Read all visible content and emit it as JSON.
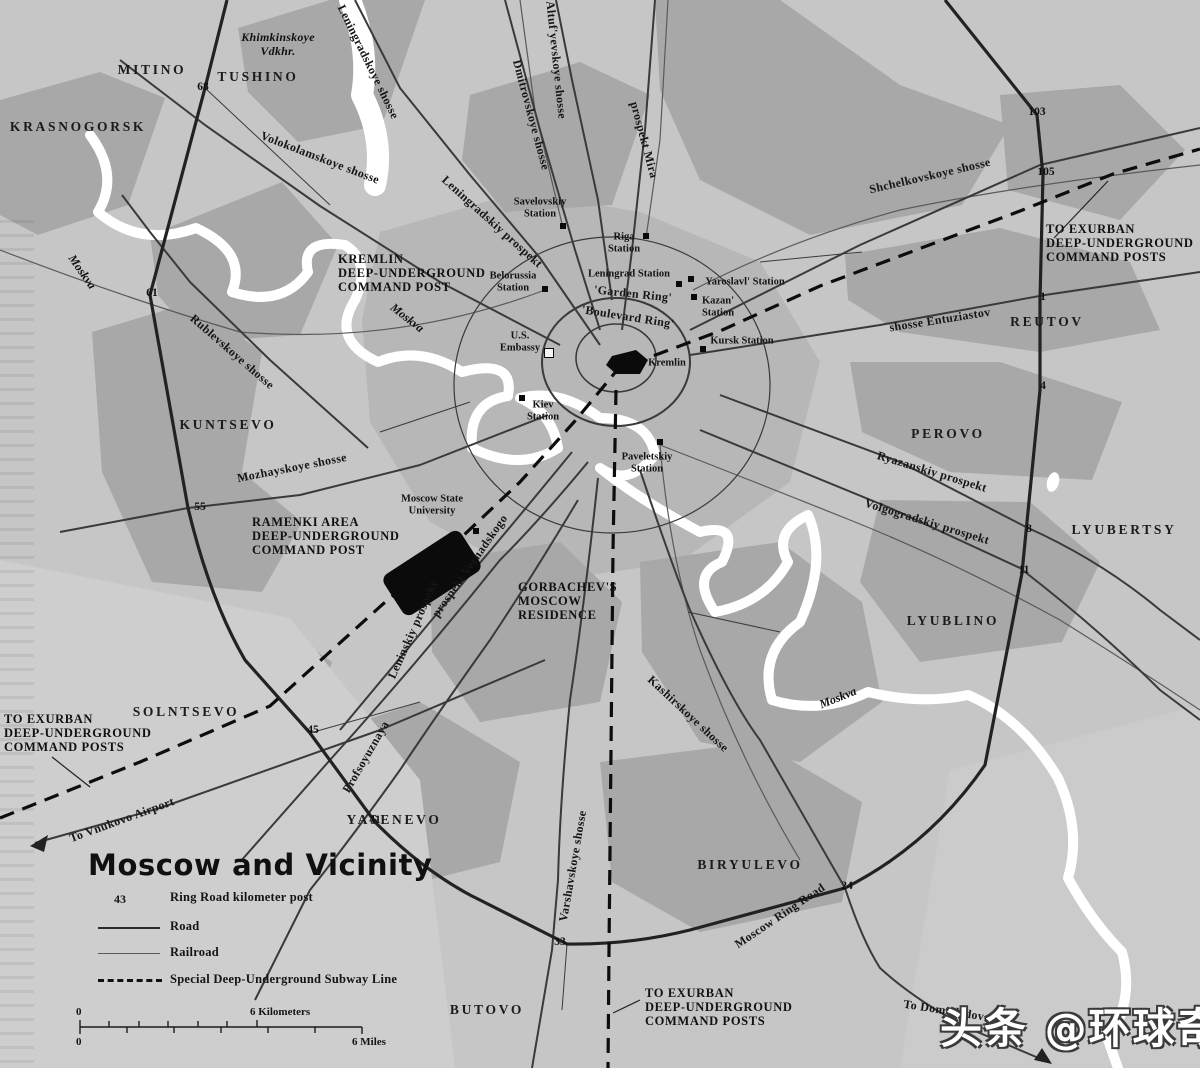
{
  "title": "Moscow and Vicinity",
  "watermark": "头条 @环球奇潭",
  "colors": {
    "background": "#c6c6c6",
    "urban_patch": "#a8a8a8",
    "water": "#ffffff",
    "road": "#2b2b2b",
    "subway_dashed": "#111111",
    "text": "#141414"
  },
  "legend": {
    "km_post_key": "43",
    "items": [
      {
        "symbol": "km-post",
        "label": "Ring Road kilometer post"
      },
      {
        "symbol": "road-line",
        "label": "Road"
      },
      {
        "symbol": "railroad-line",
        "label": "Railroad"
      },
      {
        "symbol": "subway-dashed-line",
        "label": "Special Deep-Underground Subway Line"
      }
    ]
  },
  "scale_bar": {
    "km_start": "0",
    "km_end_label": "6 Kilometers",
    "mi_start": "0",
    "mi_end_label": "6 Miles"
  },
  "map": {
    "districts": [
      {
        "text": "KRASNOGORSK",
        "x": 78,
        "y": 127
      },
      {
        "text": "MITINO",
        "x": 152,
        "y": 70
      },
      {
        "text": "TUSHINO",
        "x": 258,
        "y": 77
      },
      {
        "text": "KUNTSEVO",
        "x": 228,
        "y": 425
      },
      {
        "text": "SOLNTSEVO",
        "x": 186,
        "y": 712
      },
      {
        "text": "YASENEVO",
        "x": 394,
        "y": 820
      },
      {
        "text": "BUTOVO",
        "x": 487,
        "y": 1010
      },
      {
        "text": "BIRYULEVO",
        "x": 750,
        "y": 865
      },
      {
        "text": "LYUBLINO",
        "x": 953,
        "y": 621
      },
      {
        "text": "LYUBERTSY",
        "x": 1124,
        "y": 530
      },
      {
        "text": "PEROVO",
        "x": 948,
        "y": 434
      },
      {
        "text": "REUTOV",
        "x": 1047,
        "y": 322
      }
    ],
    "road_labels": [
      {
        "text": "Leningradskoye shosse",
        "x": 368,
        "y": 62,
        "rot": 64
      },
      {
        "text": "Volokolamskoye shosse",
        "x": 320,
        "y": 158,
        "rot": 21
      },
      {
        "text": "Dmitrovskoye shosse",
        "x": 531,
        "y": 115,
        "rot": 75
      },
      {
        "text": "Altuf'yevskoye shosse",
        "x": 556,
        "y": 60,
        "rot": 84
      },
      {
        "text": "prospekt Mira",
        "x": 644,
        "y": 140,
        "rot": 75
      },
      {
        "text": "Shchelkovskoye shosse",
        "x": 930,
        "y": 176,
        "rot": -13
      },
      {
        "text": "shosse Entuziastov",
        "x": 940,
        "y": 320,
        "rot": -9
      },
      {
        "text": "Leningradskiy prospekt",
        "x": 492,
        "y": 222,
        "rot": 42
      },
      {
        "text": "Rublevskoye shosse",
        "x": 232,
        "y": 352,
        "rot": 41
      },
      {
        "text": "Mozhayskoye shosse",
        "x": 292,
        "y": 468,
        "rot": -11
      },
      {
        "text": "prospekt Vernadskogo",
        "x": 470,
        "y": 566,
        "rot": -55
      },
      {
        "text": "Leninskiy prospekt",
        "x": 413,
        "y": 630,
        "rot": -66
      },
      {
        "text": "Profsoyuznaya",
        "x": 366,
        "y": 757,
        "rot": -60
      },
      {
        "text": "Varshavskoye shosse",
        "x": 573,
        "y": 866,
        "rot": -80
      },
      {
        "text": "Kashirskoye shosse",
        "x": 688,
        "y": 714,
        "rot": 43
      },
      {
        "text": "Ryazanskiy prospekt",
        "x": 932,
        "y": 472,
        "rot": 17
      },
      {
        "text": "Volgogradskiy prospekt",
        "x": 927,
        "y": 522,
        "rot": 17
      },
      {
        "text": "Moscow Ring Road",
        "x": 780,
        "y": 916,
        "rot": -34
      },
      {
        "text": "To Vnukovo Airport",
        "x": 122,
        "y": 820,
        "rot": -20
      },
      {
        "text": "To Domodedovo",
        "x": 947,
        "y": 1011,
        "rot": 9
      },
      {
        "text": "'Garden Ring'",
        "x": 633,
        "y": 294,
        "rot": 6
      },
      {
        "text": "'Boulevard Ring'",
        "x": 628,
        "y": 317,
        "rot": 9
      }
    ],
    "water_labels": [
      {
        "text": "Moskva",
        "x": 82,
        "y": 272,
        "rot": 55
      },
      {
        "text": "Moskva",
        "x": 407,
        "y": 318,
        "rot": 38
      },
      {
        "text": "Moskva",
        "x": 838,
        "y": 698,
        "rot": -22
      }
    ],
    "annotations": [
      {
        "id": "kremlin-command-post",
        "x": 338,
        "y": 252,
        "lines": [
          "KREMLIN",
          "DEEP-UNDERGROUND",
          "COMMAND POST"
        ]
      },
      {
        "id": "ramenki-command-post",
        "x": 252,
        "y": 515,
        "lines": [
          "RAMENKI AREA",
          "DEEP-UNDERGROUND",
          "COMMAND POST"
        ]
      },
      {
        "id": "gorbachev-residence",
        "x": 518,
        "y": 580,
        "lines": [
          "GORBACHEV'S",
          "MOSCOW",
          "RESIDENCE"
        ]
      },
      {
        "id": "exurban-northeast",
        "x": 1046,
        "y": 222,
        "lines": [
          "TO EXURBAN",
          "DEEP-UNDERGROUND",
          "COMMAND POSTS"
        ]
      },
      {
        "id": "exurban-southwest",
        "x": 4,
        "y": 712,
        "lines": [
          "TO EXURBAN",
          "DEEP-UNDERGROUND",
          "COMMAND POSTS"
        ]
      },
      {
        "id": "exurban-south",
        "x": 645,
        "y": 986,
        "lines": [
          "TO EXURBAN",
          "DEEP-UNDERGROUND",
          "COMMAND POSTS"
        ]
      }
    ],
    "reservoir_label": {
      "x": 278,
      "y": 30,
      "lines": [
        "Khimkinskoye",
        "Vdkhr."
      ]
    },
    "stations": [
      {
        "name": "savelovskiy-station",
        "lines": [
          "Savelovskiy",
          "Station"
        ],
        "lx": 540,
        "ly": 208,
        "mx": 563,
        "my": 226,
        "marker": "b"
      },
      {
        "name": "riga-station",
        "lines": [
          "Riga",
          "Station"
        ],
        "lx": 624,
        "ly": 243,
        "mx": 646,
        "my": 236,
        "marker": "b"
      },
      {
        "name": "belorussia-station",
        "lines": [
          "Belorussia",
          "Station"
        ],
        "lx": 513,
        "ly": 282,
        "mx": 545,
        "my": 289,
        "marker": "b"
      },
      {
        "name": "leningrad-station",
        "lines": [
          "Leningrad Station"
        ],
        "lx": 629,
        "ly": 274,
        "mx": 679,
        "my": 284,
        "marker": "b"
      },
      {
        "name": "yaroslavl-station",
        "lines": [
          "Yaroslavl' Station"
        ],
        "lx": 745,
        "ly": 282,
        "mx": 691,
        "my": 279,
        "marker": "b"
      },
      {
        "name": "kazan-station",
        "lines": [
          "Kazan'",
          "Station"
        ],
        "lx": 718,
        "ly": 307,
        "mx": 694,
        "my": 297,
        "marker": "b"
      },
      {
        "name": "kursk-station",
        "lines": [
          "Kursk Station"
        ],
        "lx": 742,
        "ly": 341,
        "mx": 703,
        "my": 349,
        "marker": "b"
      },
      {
        "name": "kiev-station",
        "lines": [
          "Kiev",
          "Station"
        ],
        "lx": 543,
        "ly": 411,
        "mx": 522,
        "my": 398,
        "marker": "b"
      },
      {
        "name": "paveletskiy-station",
        "lines": [
          "Paveletskiy",
          "Station"
        ],
        "lx": 647,
        "ly": 463,
        "mx": 660,
        "my": 442,
        "marker": "b"
      },
      {
        "name": "moscow-state-university",
        "lines": [
          "Moscow State",
          "University"
        ],
        "lx": 432,
        "ly": 505,
        "mx": 476,
        "my": 531,
        "marker": "b"
      },
      {
        "name": "us-embassy",
        "lines": [
          "U.S.",
          "Embassy"
        ],
        "lx": 520,
        "ly": 342,
        "mx": 549,
        "my": 353,
        "marker": "w"
      },
      {
        "name": "kremlin",
        "lines": [
          "Kremlin"
        ],
        "lx": 667,
        "ly": 363,
        "mx": 0,
        "my": 0,
        "marker": "none"
      }
    ],
    "km_posts": [
      {
        "value": "68",
        "x": 203,
        "y": 87
      },
      {
        "value": "61",
        "x": 152,
        "y": 293
      },
      {
        "value": "55",
        "x": 200,
        "y": 507
      },
      {
        "value": "45",
        "x": 313,
        "y": 730
      },
      {
        "value": "41",
        "x": 375,
        "y": 820
      },
      {
        "value": "33",
        "x": 560,
        "y": 942
      },
      {
        "value": "24",
        "x": 847,
        "y": 886
      },
      {
        "value": "11",
        "x": 1024,
        "y": 570
      },
      {
        "value": "8",
        "x": 1029,
        "y": 529
      },
      {
        "value": "4",
        "x": 1043,
        "y": 386
      },
      {
        "value": "1",
        "x": 1043,
        "y": 297
      },
      {
        "value": "105",
        "x": 1046,
        "y": 172
      },
      {
        "value": "103",
        "x": 1037,
        "y": 112
      }
    ]
  }
}
